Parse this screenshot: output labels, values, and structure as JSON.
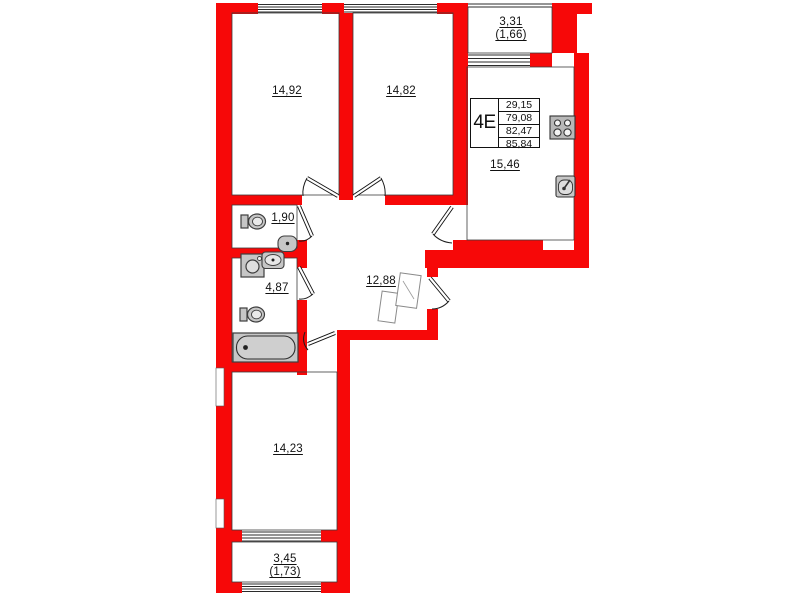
{
  "plan": {
    "unit": {
      "label": "4E",
      "area_rows": [
        "29,15",
        "79,08",
        "82,47",
        "85,84"
      ]
    },
    "rooms": {
      "bedroom_top_left": "14,92",
      "bedroom_top_right": "14,82",
      "balcony_top": "3,31",
      "balcony_top_reduced": "(1,66)",
      "kitchen": "15,46",
      "wc": "1,90",
      "bathroom": "4,87",
      "hallway": "12,88",
      "bedroom_bottom": "14,23",
      "balcony_bottom": "3,45",
      "balcony_bottom_reduced": "(1,73)"
    },
    "colors": {
      "wall": "#f70808",
      "fixture_fill": "#c6c6c6",
      "fixture_stroke": "#3d3d3d",
      "line": "#1c1c1c"
    }
  }
}
